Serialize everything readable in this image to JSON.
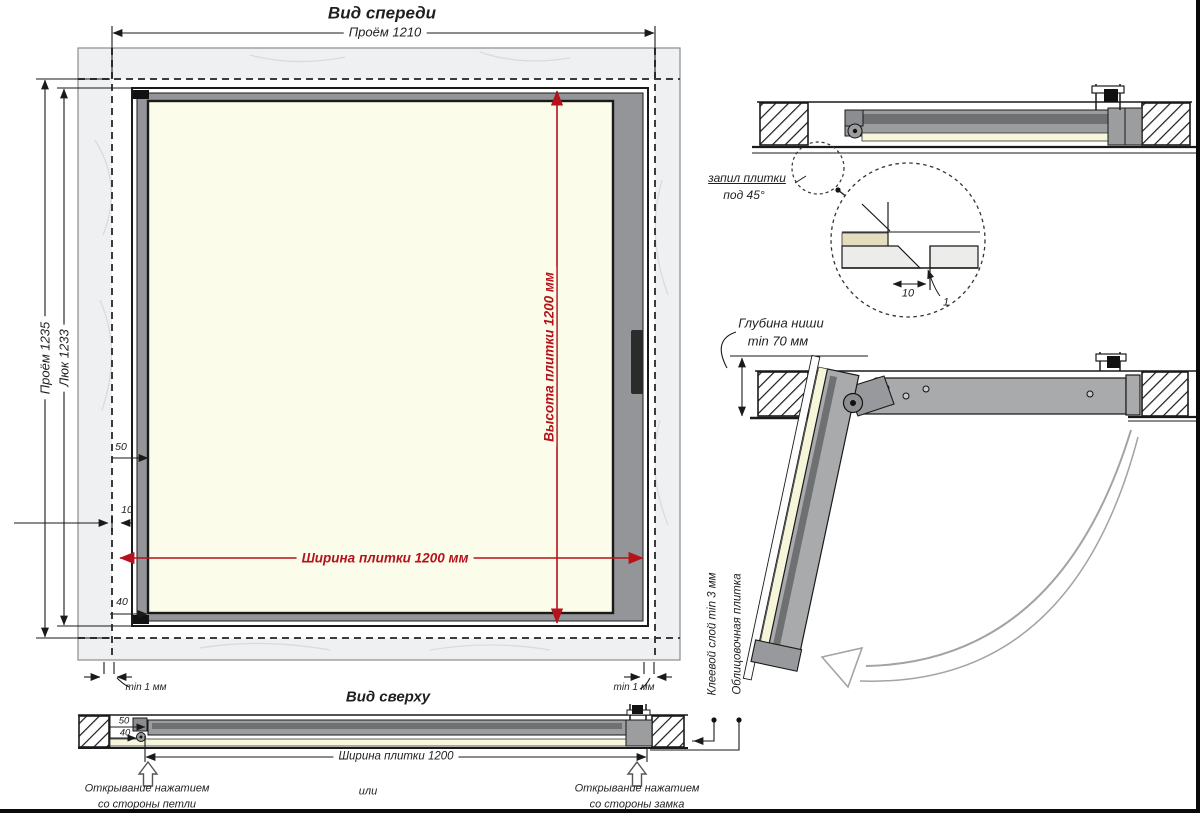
{
  "front_view": {
    "title": "Вид спереди",
    "dim_opening_width": "Проём 1210",
    "dim_opening_height": "Проём 1235",
    "dim_hatch_height": "Люк 1233",
    "dim_tile_width": "Ширина плитки 1200 мм",
    "dim_tile_height": "Высота плитки 1200 мм",
    "dim_50": "50",
    "dim_10": "10",
    "dim_40": "40",
    "min_gap_left": "min 1 мм",
    "min_gap_right": "min 1 мм"
  },
  "top_view": {
    "title": "Вид сверху",
    "dim_tile_width": "Ширина плитки 1200",
    "dim_50": "50",
    "dim_40": "40",
    "or_label": "или",
    "open_hinge_line1": "Открывание нажатием",
    "open_hinge_line2": "со стороны петли",
    "open_lock_line1": "Открывание нажатием",
    "open_lock_line2": "со стороны замка",
    "glue_layer_label": "Клеевой слой min 3 мм",
    "facing_tile_label": "Облицовочная плитка"
  },
  "section_view": {
    "tile_cut_line1": "запил плитки",
    "tile_cut_line2": "под 45°",
    "detail_dim_10": "10",
    "detail_dim_1": "1"
  },
  "open_view": {
    "niche_depth_line1": "Глубина ниши",
    "niche_depth_line2": "min 70 мм"
  },
  "colors": {
    "dimension_red": "#b5121b",
    "tile_cream": "#fbfce9",
    "frame_gray": "#939598",
    "wall_gray": "#eef0f2",
    "line_black": "#1a1a1a"
  }
}
